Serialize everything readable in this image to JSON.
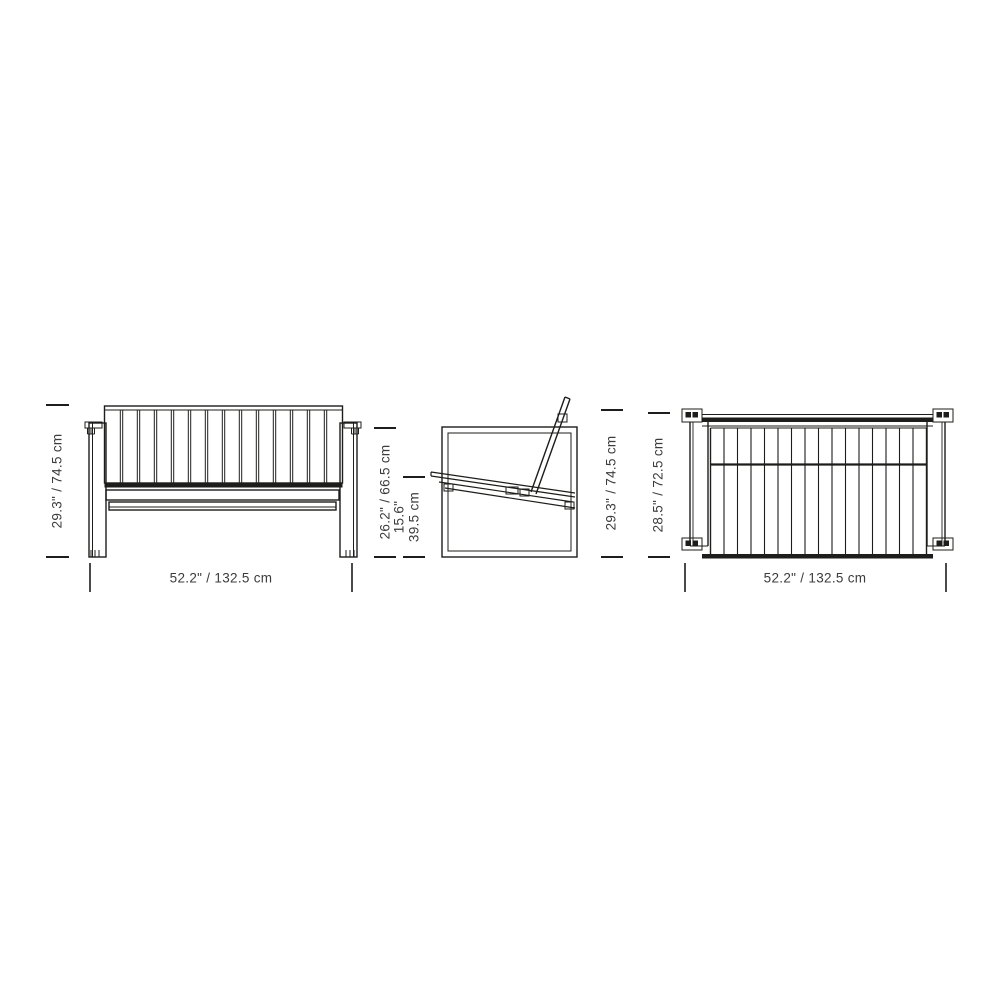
{
  "figure": {
    "title": "Outdoor slatted lounge sofa dimension drawing",
    "type": "technical-dimension-diagram",
    "colors": {
      "line": "#1d1d1b",
      "text": "#3c3c3b",
      "background": "#ffffff"
    },
    "views": {
      "front": {
        "name": "front view",
        "height_label": "29.3\" / 74.5 cm",
        "width_label": "52.2\" / 132.5 cm"
      },
      "side": {
        "name": "side view",
        "frame_height_label": "26.2\" / 66.5 cm",
        "seat_height_label": "15.6\"\n39.5 cm",
        "overall_height_label": "29.3\" / 74.5 cm"
      },
      "top": {
        "name": "top view",
        "depth_label": "28.5\" / 72.5 cm",
        "width_label": "52.2\" / 132.5 cm"
      }
    }
  }
}
